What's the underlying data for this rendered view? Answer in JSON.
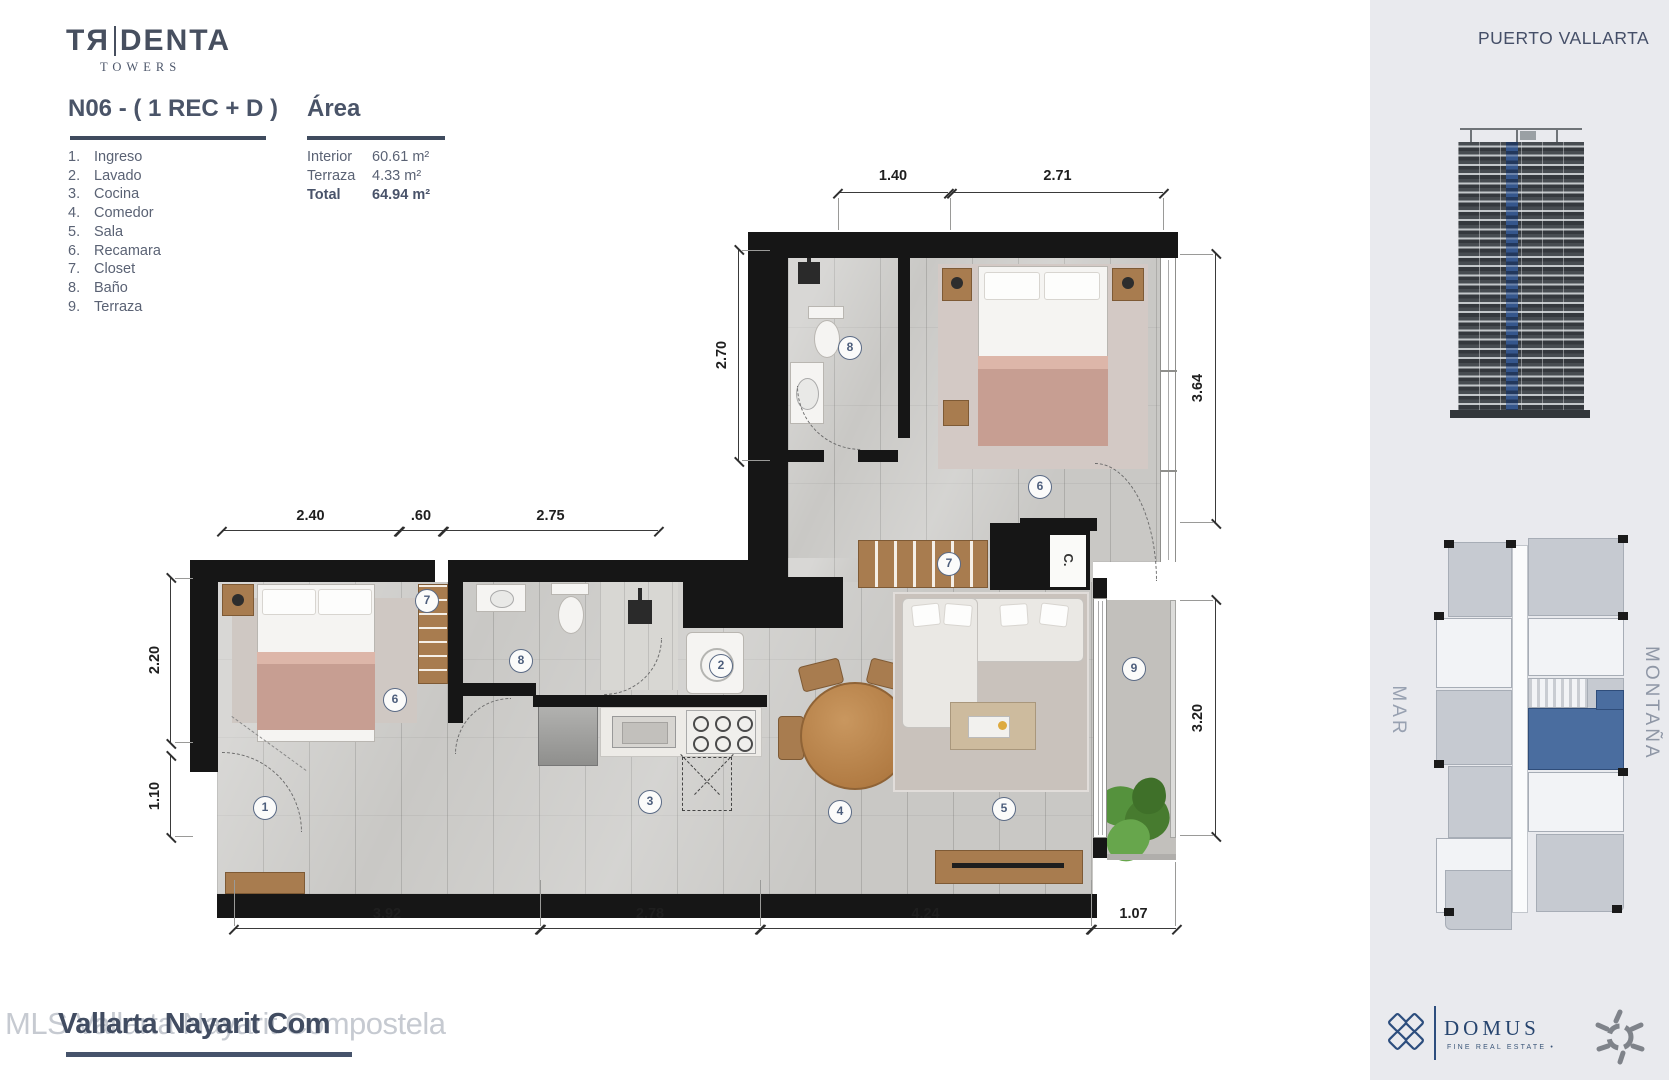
{
  "brand": {
    "tr": "TЯ",
    "denta": "DENTA",
    "sub": "TOWERS"
  },
  "titles": {
    "unit": "N06 - ( 1 REC + D )",
    "area": "Área"
  },
  "legend": [
    {
      "num": "1.",
      "label": "Ingreso"
    },
    {
      "num": "2.",
      "label": "Lavado"
    },
    {
      "num": "3.",
      "label": "Cocina"
    },
    {
      "num": "4.",
      "label": "Comedor"
    },
    {
      "num": "5.",
      "label": "Sala"
    },
    {
      "num": "6.",
      "label": "Recamara"
    },
    {
      "num": "7.",
      "label": "Closet"
    },
    {
      "num": "8.",
      "label": "Baño"
    },
    {
      "num": "9.",
      "label": "Terraza"
    }
  ],
  "area_table": [
    {
      "label": "Interior",
      "value": "60.61 m²"
    },
    {
      "label": "Terraza",
      "value": "4.33 m²"
    },
    {
      "label": "Total",
      "value": "64.94 m²"
    }
  ],
  "plan": {
    "closet_label": "C.",
    "dims": [
      {
        "label": "1.40"
      },
      {
        "label": "2.71"
      },
      {
        "label": "2.40"
      },
      {
        "label": ".60"
      },
      {
        "label": "2.75"
      },
      {
        "label": "3.92"
      },
      {
        "label": "2.78"
      },
      {
        "label": "4.24"
      },
      {
        "label": "1.07"
      },
      {
        "label": "2.70"
      },
      {
        "label": "2.20"
      },
      {
        "label": "1.10"
      },
      {
        "label": "3.64"
      },
      {
        "label": "3.20"
      }
    ],
    "markers": [
      {
        "n": "1"
      },
      {
        "n": "2"
      },
      {
        "n": "3"
      },
      {
        "n": "4"
      },
      {
        "n": "5"
      },
      {
        "n": "6"
      },
      {
        "n": "6"
      },
      {
        "n": "7"
      },
      {
        "n": "7"
      },
      {
        "n": "8"
      },
      {
        "n": "8"
      },
      {
        "n": "9"
      }
    ]
  },
  "sidebar": {
    "city": "PUERTO VALLARTA",
    "label_left": "MAR",
    "label_right": "MONTAÑA",
    "domus_name": "DOMUS",
    "domus_tagline": "FINE REAL ESTATE •"
  },
  "watermark": {
    "light": "MLS Vallarta Nayarit Compostela",
    "bold": "Vallarta Nayarit Com"
  },
  "colors": {
    "accent_blue": "#4a6d9f",
    "navy": "#44506a",
    "wall_black": "#161616",
    "wood": "#a87c4f"
  }
}
